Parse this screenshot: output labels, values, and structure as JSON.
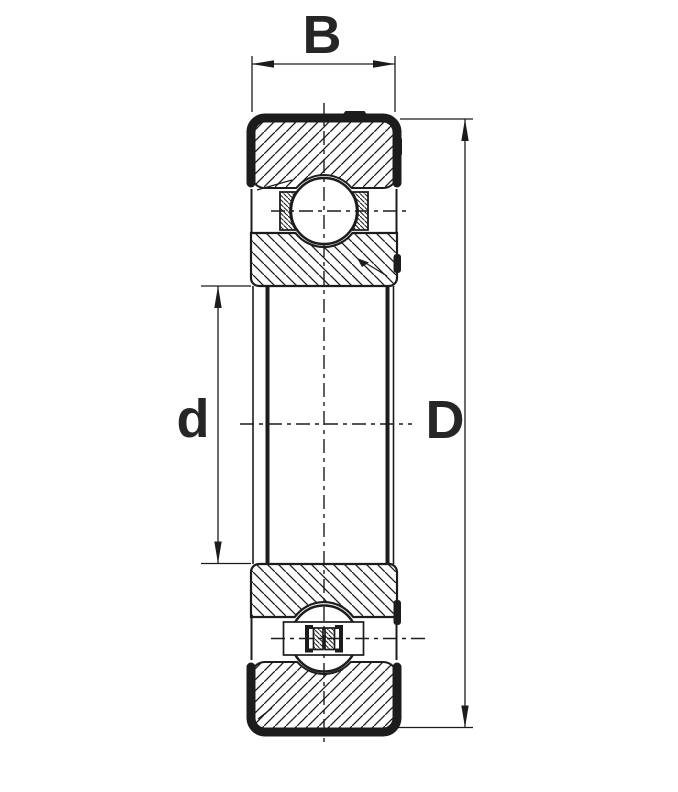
{
  "diagram": {
    "type": "technical-drawing",
    "subject": "Deep groove ball bearing cross-section (axial section view)",
    "labels": {
      "width": "B",
      "bore_diameter": "d",
      "outer_diameter": "D"
    },
    "components": [
      "outer-ring-top-section",
      "inner-ring-top-section",
      "ball-top-with-cage",
      "bore",
      "inner-ring-bottom-section",
      "ball-bottom-with-riveted-cage",
      "outer-ring-bottom-section"
    ],
    "colors": {
      "line": "#1c1c1c",
      "label": "#262626",
      "background": "#ffffff"
    }
  }
}
